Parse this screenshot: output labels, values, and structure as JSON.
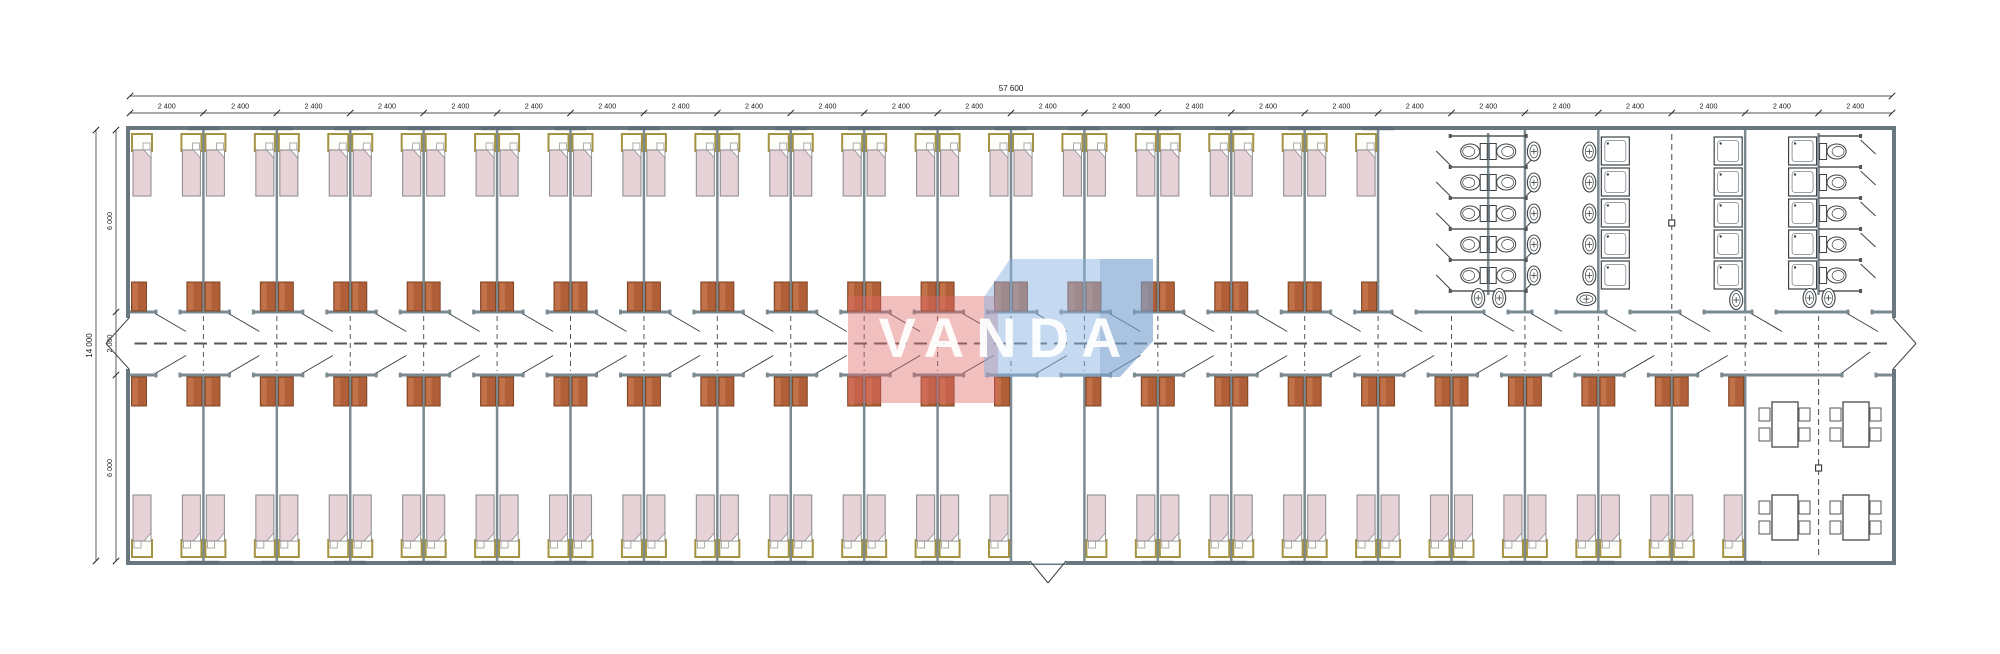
{
  "watermark": {
    "text": "VANDA",
    "red_color": "#e06666",
    "blue_color": "#8cb4e1",
    "text_color": "#ffffff"
  },
  "dimensions": {
    "top": {
      "total": "57 600",
      "segment": "2 400",
      "segment_count": 24
    },
    "left": {
      "total": "14 000",
      "segments": [
        "6 000",
        "2 000",
        "6 000"
      ]
    }
  },
  "building": {
    "modules_total": 24,
    "top_wing": {
      "bedroom_modules": 17,
      "beds": 34,
      "wardrobes": 34,
      "sanitary": {
        "toilet_stall_rows": 5,
        "back_to_back_toilets": 10,
        "end_wc_stalls": 5,
        "washbasin_columns": 2,
        "washbasins_per_column": 5,
        "shower_columns": 3,
        "showers_per_column": 5
      }
    },
    "bottom_wing": {
      "modules_before_dining": 22,
      "bedroom_modules": 21,
      "vestibule_module_index": 13,
      "beds": 42,
      "wardrobes": 42,
      "dining": {
        "tables": 4,
        "chairs_per_table": 4
      }
    }
  },
  "colors": {
    "wall": "#7b8a91",
    "exterior_wall": "#69787f",
    "window": "#5f6e76",
    "mattress": "#e7d3d7",
    "bed_frame": "#a39343",
    "wardrobe": "#b05f38",
    "wardrobe_light": "#cf8256",
    "fixture_line": "#3c4246",
    "dashed_axis": "#53585b",
    "dimension_text": "#1a1a1a"
  }
}
